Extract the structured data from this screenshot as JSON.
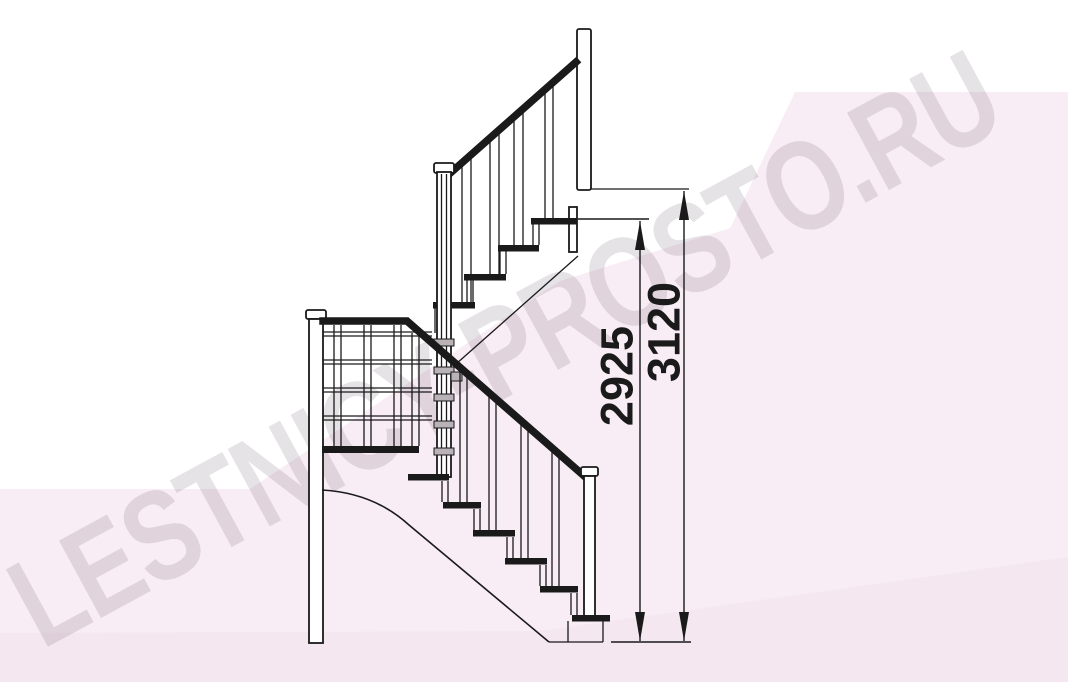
{
  "watermark": {
    "text": "LESTNICY-PROSTO.RU"
  },
  "dimensions": {
    "height_to_top_step": "2925",
    "total_height": "3120"
  },
  "colors": {
    "line": "#1a1a1a",
    "background": "#ffffff",
    "pink_wedge": "#f8edf4",
    "pink_band": "#f5e7f0",
    "watermark_text": "rgba(80,60,75,0.14)",
    "block_fill": "#b9b2b6"
  }
}
